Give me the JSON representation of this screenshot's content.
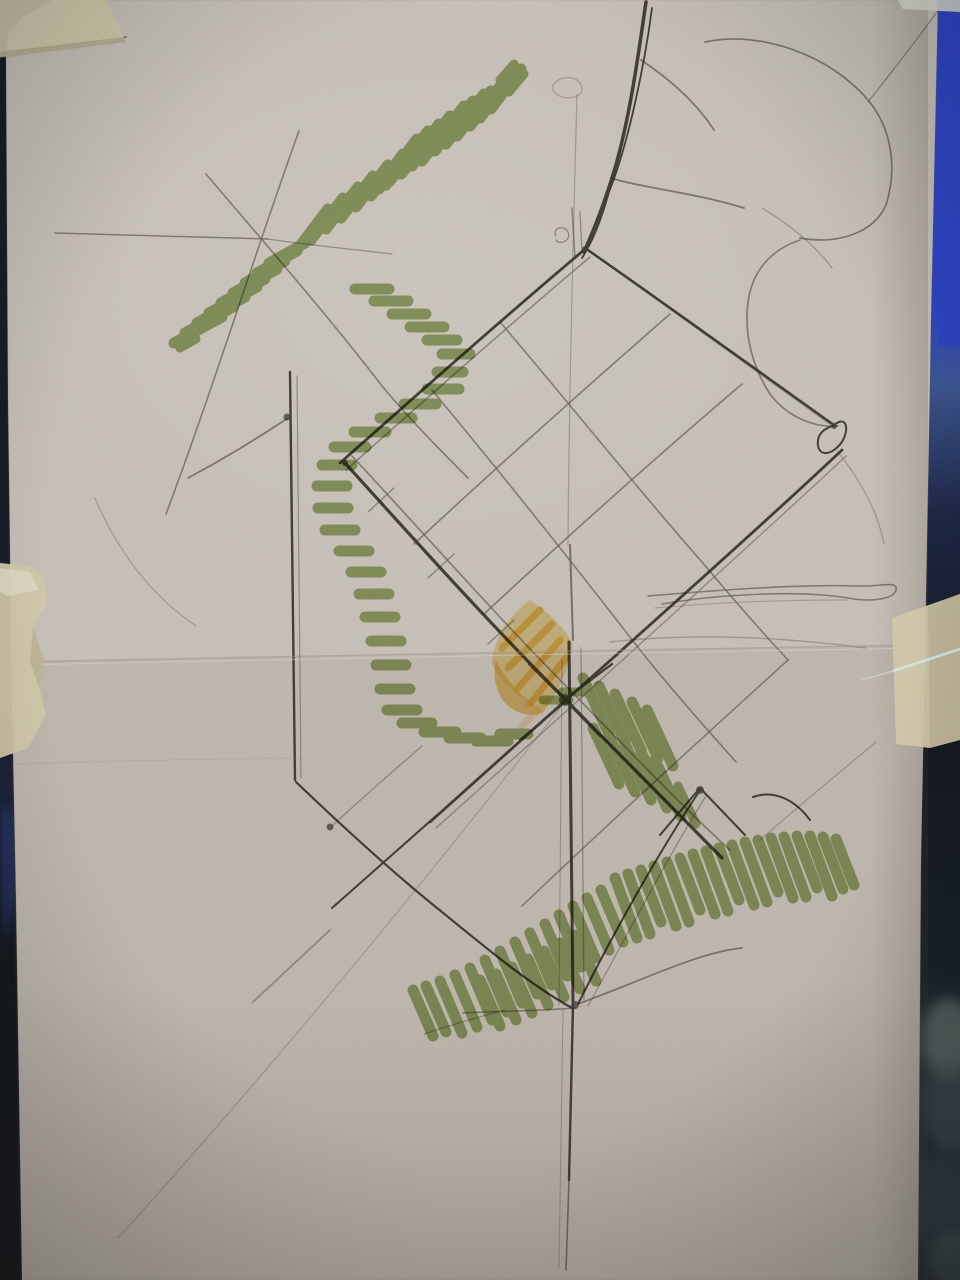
{
  "scene": {
    "type": "photograph",
    "subject": "hand-drawn urban design concept sketch",
    "medium": "graphite pencil with green and orange marker on tracing paper",
    "support": "folded sheet taped with masking tape to a dark surface",
    "features": {
      "street_grid": "diagonal sketched street grid rotated about 45 degrees",
      "vegetation": "green marker hatching bands marking landscape areas",
      "focal_block": "orange marker diamond highlighting a central block",
      "fold": "horizontal fold crease across the middle of the sheet"
    }
  },
  "colors": {
    "background": "#12161f",
    "edge_blue": "#2b43c6",
    "edge_blue_dim": "#3a5694",
    "edge_navy": "#1b2544",
    "edge_teal": "#242f36",
    "paper": "#c8c2ba",
    "tape": "#d4caab",
    "tape_light": "#e2dbc4",
    "pencil": "#4a443d",
    "pencil_dark": "#2f2a26",
    "marker_green": "#7e9c40",
    "marker_orange": "#e8a818",
    "marker_orange_light": "#f0c94e",
    "crease": "#9a9183",
    "crease_light": "#e6e1d5",
    "streak": "#d6ecf2"
  }
}
